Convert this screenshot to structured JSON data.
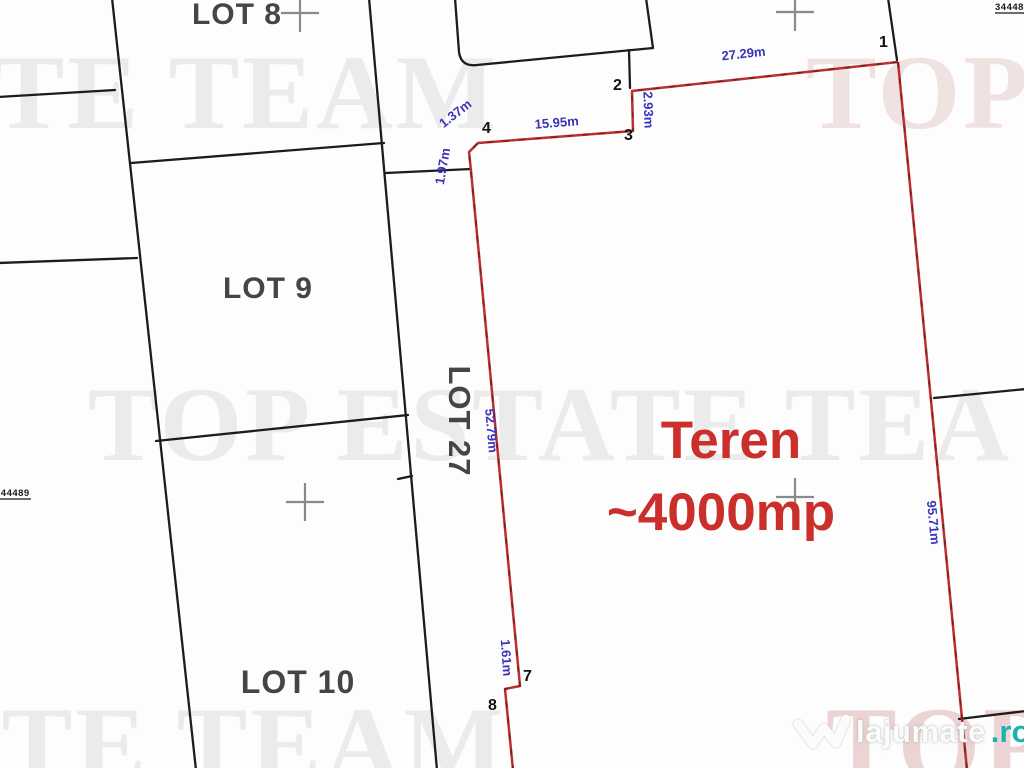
{
  "lots": {
    "lot8": "LOT 8",
    "lot9": "LOT 9",
    "lot10": "LOT 10",
    "lot27": "LOT 27"
  },
  "parcel": {
    "area_line1": "Teren",
    "area_line2": "~4000mp",
    "points": {
      "p1": "1",
      "p2": "2",
      "p3": "3",
      "p4": "4",
      "p7": "7",
      "p8": "8"
    },
    "measurements": {
      "s12": "27.29m",
      "s23": "2.93m",
      "s34": "15.95m",
      "s45": "1.37m",
      "s56": "1.97m",
      "s67": "52.79m",
      "s78": "1.61m",
      "s19": "95.71m"
    }
  },
  "cadastral_marks": {
    "left_edge": "344489",
    "top_right": "344489"
  },
  "watermark": {
    "full_text": "TOP ESTATE TEAM",
    "row1_left": "ATE TEAM",
    "row1_right": "TOP",
    "row2": "TOP ESTATE TEA",
    "row3_left": "ATE TEAM",
    "row3_right": "TOP"
  },
  "logo": {
    "brand": "lajumate",
    "tld": ".ro"
  },
  "colors": {
    "parcel_outline": "#bf2e2e",
    "area_text": "#cb2f2b",
    "dimension_text": "#3a34b8",
    "boundary_lines": "#1c1c1c",
    "grid_cross": "#8a8a8a",
    "watermark_gray": "#ebebeb",
    "watermark_pink": "#f1e2e2",
    "logo_teal": "#1fb1ac"
  }
}
